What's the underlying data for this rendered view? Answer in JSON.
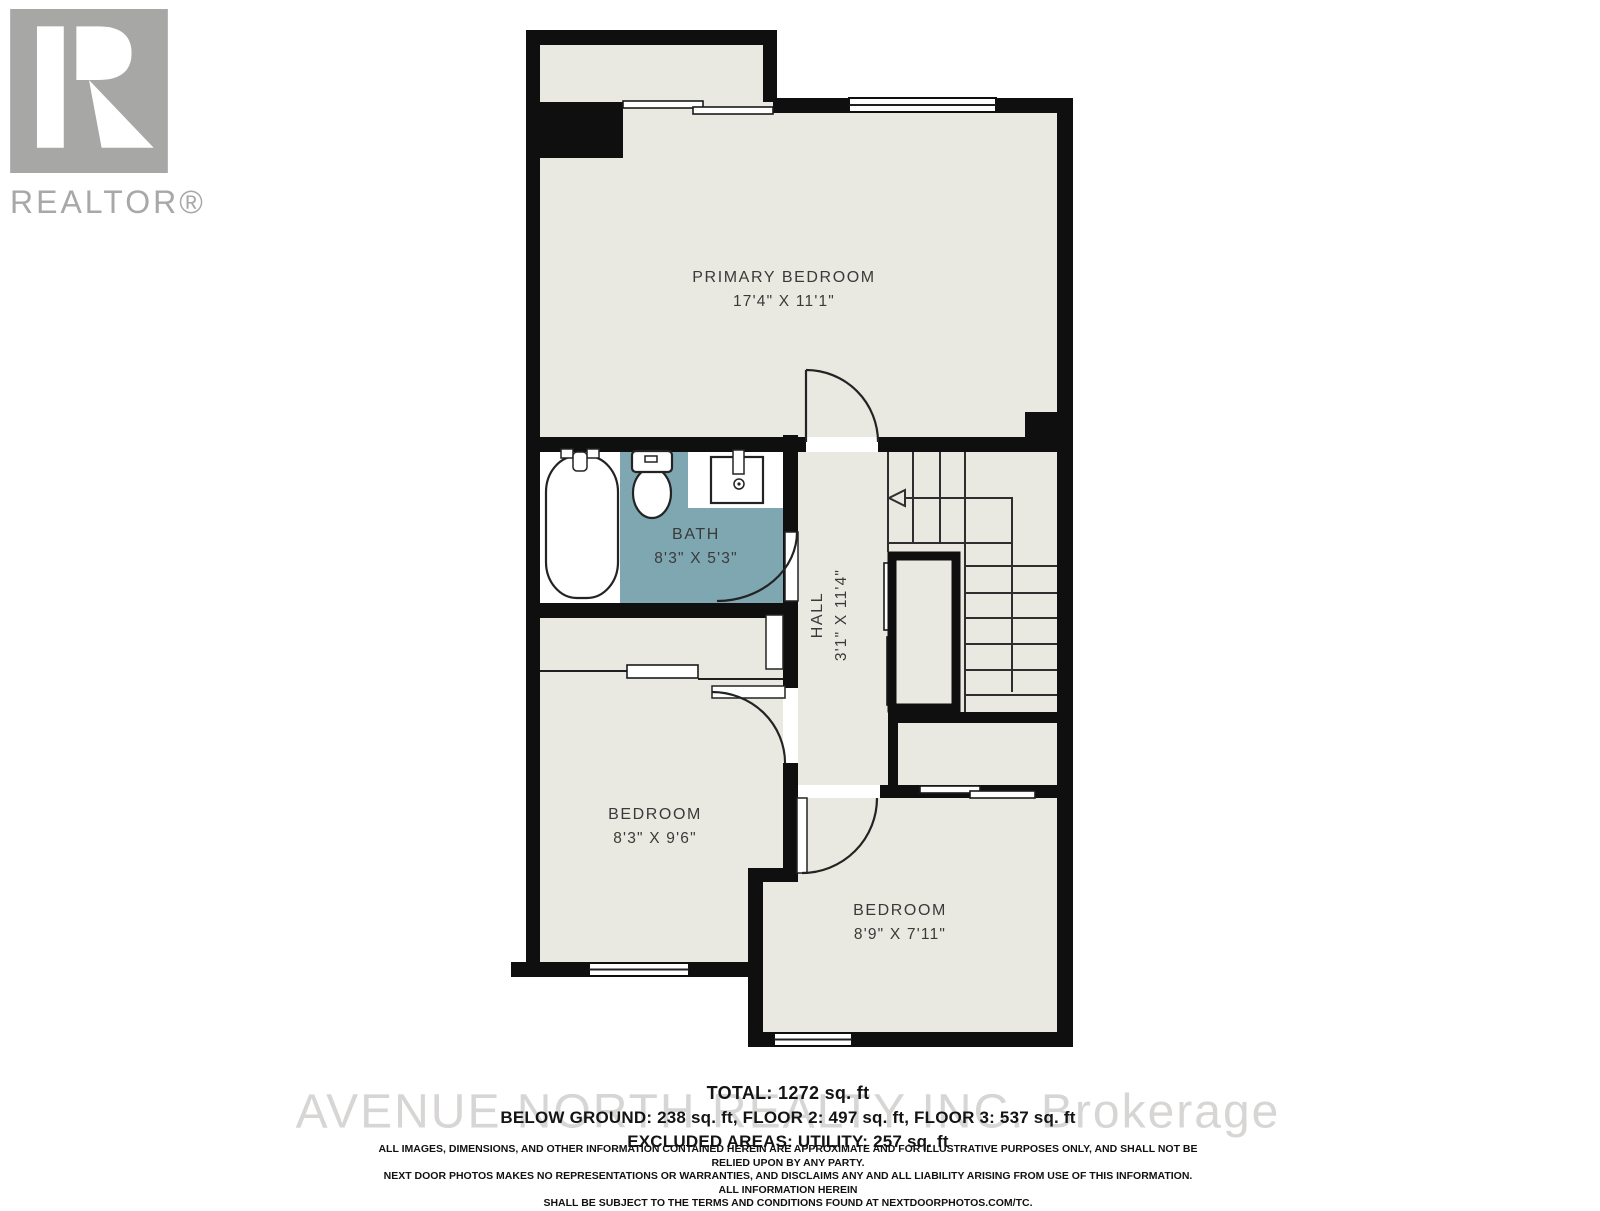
{
  "branding": {
    "logo_letter": "R",
    "wordmark": "REALTOR®"
  },
  "watermark": "AVENUE NORTH REALTY INC. Brokerage",
  "rooms": {
    "primary_bedroom": {
      "name": "PRIMARY BEDROOM",
      "dims": "17'4\" X 11'1\""
    },
    "bath": {
      "name": "BATH",
      "dims": "8'3\" X 5'3\""
    },
    "hall": {
      "name": "HALL",
      "dims": "3'1\" X 11'4\""
    },
    "bedroom_left": {
      "name": "BEDROOM",
      "dims": "8'3\" X 9'6\""
    },
    "bedroom_right": {
      "name": "BEDROOM",
      "dims": "8'9\" X 7'11\""
    }
  },
  "summary": {
    "total": "TOTAL: 1272 sq. ft",
    "floors": "BELOW GROUND: 238 sq. ft, FLOOR 2: 497 sq. ft, FLOOR 3: 537 sq. ft",
    "excluded": "EXCLUDED AREAS: UTILITY: 257 sq. ft"
  },
  "disclaimer": {
    "lines": [
      "ALL IMAGES, DIMENSIONS, AND OTHER INFORMATION CONTAINED HEREIN ARE APPROXIMATE AND FOR ILLUSTRATIVE PURPOSES ONLY, AND SHALL NOT BE RELIED UPON BY ANY PARTY.",
      "NEXT DOOR PHOTOS MAKES NO REPRESENTATIONS OR WARRANTIES, AND DISCLAIMS ANY AND ALL LIABILITY ARISING FROM USE OF THIS INFORMATION. ALL INFORMATION HEREIN",
      "SHALL BE SUBJECT TO THE TERMS AND CONDITIONS FOUND AT NEXTDOORPHOTOS.COM/TC."
    ]
  },
  "colors": {
    "floor": "#E9E8E1",
    "wall": "#0F0F0F",
    "bath_teal": "#7FA7B1",
    "label_text": "#3A3A3A",
    "logo_gray": "#A7A7A6",
    "watermark_gray": "#D7D6D4"
  }
}
